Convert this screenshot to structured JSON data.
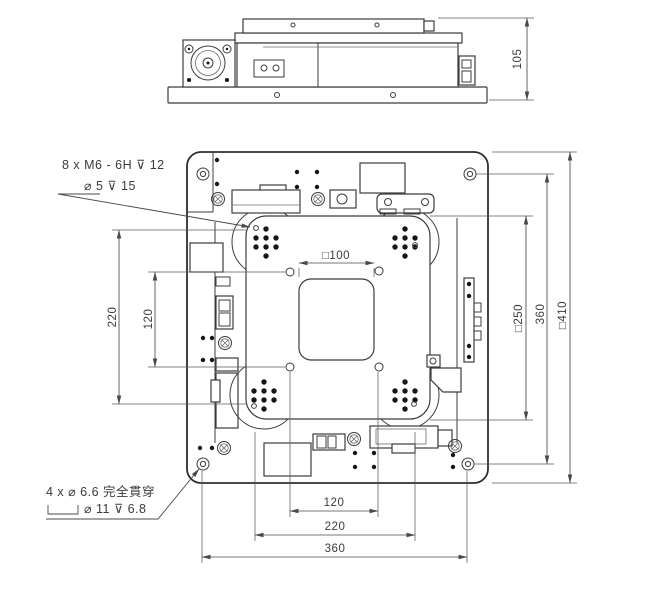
{
  "side_view": {
    "height": "105"
  },
  "plan_view": {
    "aperture": "□100",
    "left": {
      "inner": "120",
      "outer": "220"
    },
    "right": {
      "inner": "□250",
      "middle": "360",
      "outer": "□410"
    },
    "bottom": {
      "inner": "120",
      "middle": "220",
      "outer": "360"
    }
  },
  "callouts": {
    "tapped": {
      "line1": "8 x M6 - 6H ⊽ 12",
      "line2": "⌀ 5 ⊽ 15"
    },
    "through": {
      "line1": "4 x ⌀ 6.6 完全貫穿",
      "line2": "⌀ 11 ⊽ 6.8",
      "counterbore_symbol": "⌴"
    }
  },
  "colors": {
    "line": "#3c3c3c",
    "dimension": "#4a4a4a",
    "background": "#ffffff"
  }
}
